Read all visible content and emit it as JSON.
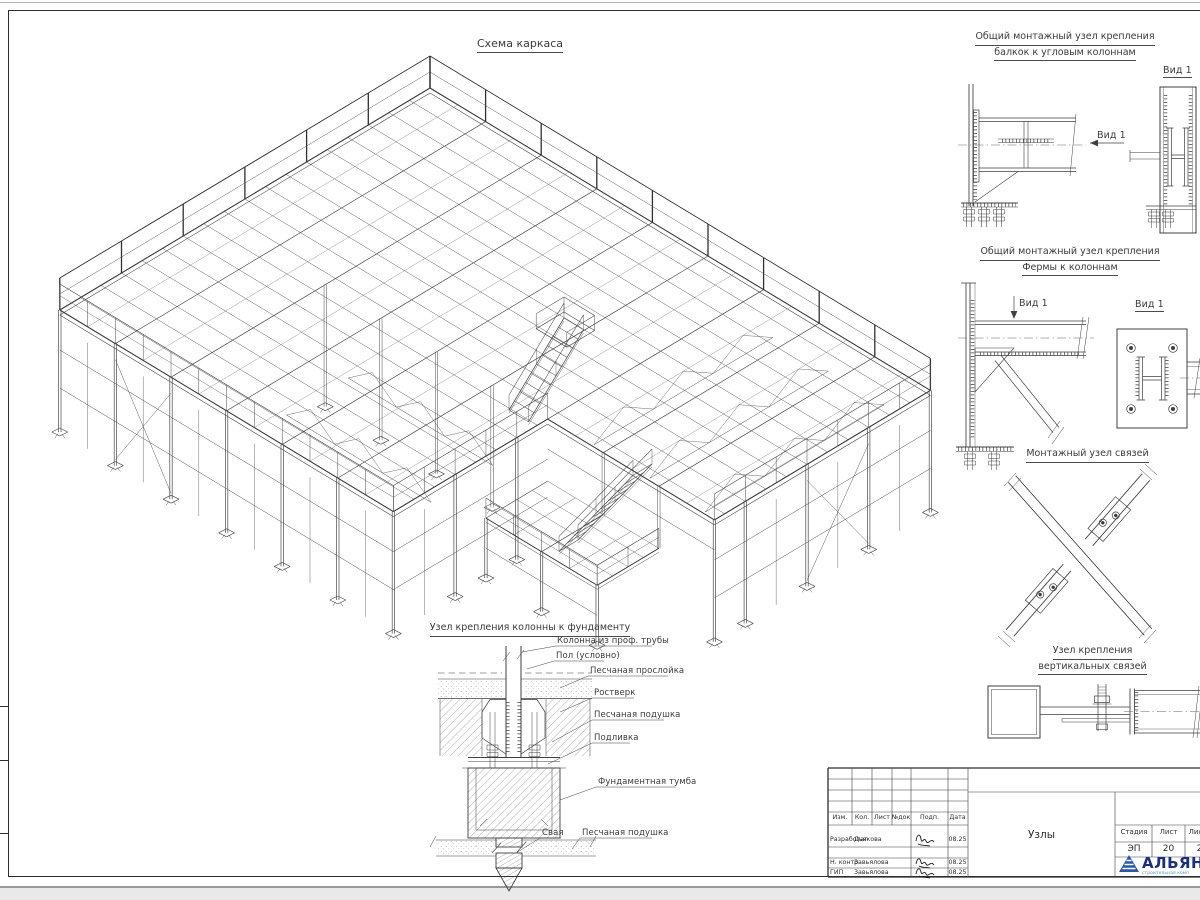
{
  "main_title": "Схема каркаса",
  "d1": {
    "t1": "Общий монтажный узел крепления",
    "t2": "балкок к угловым колоннам",
    "view": "Вид 1",
    "arrow": "Вид 1"
  },
  "d2": {
    "t1": "Общий монтажный узел крепления",
    "t2": "Фермы к колоннам",
    "view": "Вид 1",
    "arrow": "Вид 1"
  },
  "d3": {
    "t": "Монтажный узел связей"
  },
  "d4": {
    "t1": "Узел крепления",
    "t2": "вертикальных связей"
  },
  "fnd": {
    "title": "Узел крепления колонны к фундаменту",
    "labels": {
      "column": "Колонна из проф. трубы",
      "floor": "Пол (условно)",
      "sand_layer": "Песчаная прослойка",
      "grillage": "Ростверк",
      "sand_cushion": "Песчаная подушка",
      "grout": "Подливка",
      "pedestal": "Фундаментная тумба",
      "pile": "Свая",
      "sand_cushion2": "Песчаная подушка"
    }
  },
  "titleblock": {
    "headers": {
      "izm": "Изм.",
      "kol": "Кол.",
      "list": "Лист",
      "ndok": "№док",
      "podp": "Подп.",
      "data": "Дата"
    },
    "rows": [
      {
        "role": "Разработал",
        "name": "Дьякова",
        "date": "08.25"
      },
      {
        "role": "Н. контр.",
        "name": "Завьялова",
        "date": "08.25"
      },
      {
        "role": "ГИП",
        "name": "Завьялова",
        "date": "08.25"
      }
    ],
    "stage": {
      "h1": "Стадия",
      "h2": "Лист",
      "h3": "Лис",
      "v1": "ЭП",
      "v2": "20",
      "v3": "2"
    },
    "doc_title": "Узлы",
    "logo_text": "АЛЬЯН",
    "logo_sub": "строительная комп"
  },
  "colors": {
    "line": "#3f3f3f",
    "logo_triangle": "#2456b8",
    "logo_text": "#1b2f80",
    "logo_sub": "#4e9ad0"
  }
}
